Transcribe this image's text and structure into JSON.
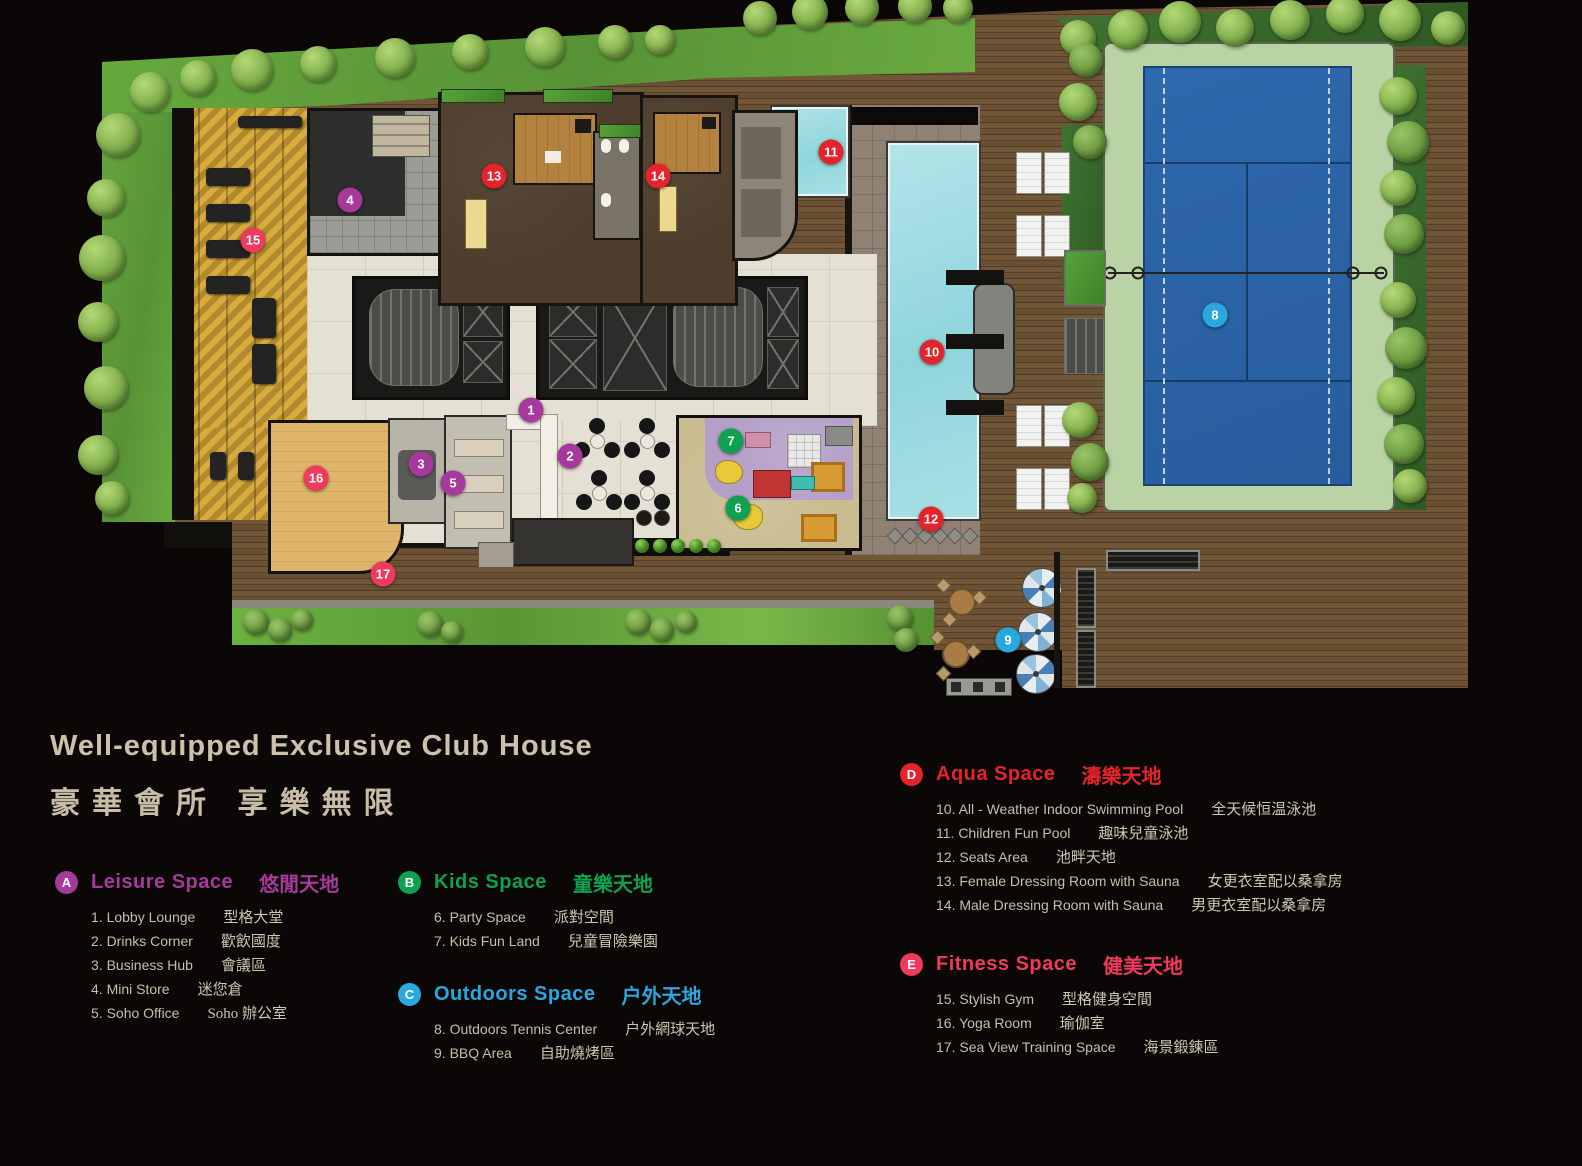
{
  "title": {
    "en": "Well-equipped Exclusive Club House",
    "zh": "豪華會所  享樂無限"
  },
  "palette": {
    "background": "#0a0706",
    "title_text": "#cdc1ab",
    "item_text": "#c8bead",
    "deck_wood": "#6a5134",
    "lawn_green": "#5f9c3c",
    "pool_water": "#a5dde2",
    "tennis_court_blue": "#2b64a8",
    "tennis_surround_green": "#b9d3a4",
    "gym_floor_gold": "#d8a83a",
    "yoga_floor": "#dcb06a",
    "kids_carpet": "#b49fc7",
    "marble_floor": "#e5e0d4"
  },
  "legend": {
    "sections": [
      {
        "letter": "A",
        "color": "#a63a9c",
        "title_en": "Leisure Space",
        "title_zh": "悠閒天地",
        "items": [
          {
            "en": "1. Lobby Lounge",
            "zh": "型格大堂"
          },
          {
            "en": "2. Drinks  Corner",
            "zh": "歡飲國度"
          },
          {
            "en": "3. Business Hub",
            "zh": "會議區"
          },
          {
            "en": "4. Mini Store",
            "zh": "迷您倉"
          },
          {
            "en": "5. Soho Office",
            "zh": "Soho 辦公室"
          }
        ]
      },
      {
        "letter": "B",
        "color": "#0da150",
        "title_en": "Kids Space",
        "title_zh": "童樂天地",
        "items": [
          {
            "en": "6. Party Space",
            "zh": "派對空間"
          },
          {
            "en": "7. Kids Fun Land",
            "zh": "兒童冒險樂園"
          }
        ]
      },
      {
        "letter": "C",
        "color": "#29a8e0",
        "title_en": "Outdoors Space",
        "title_zh": "户外天地",
        "items": [
          {
            "en": "8. Outdoors Tennis Center",
            "zh": "户外網球天地"
          },
          {
            "en": "9. BBQ Area",
            "zh": "自助燒烤區"
          }
        ]
      },
      {
        "letter": "D",
        "color": "#e5232b",
        "title_en": "Aqua Space",
        "title_zh": "濤樂天地",
        "items": [
          {
            "en": "10. All - Weather Indoor Swimming Pool",
            "zh": "全天候恒温泳池"
          },
          {
            "en": "11. Children Fun Pool",
            "zh": "趣味兒童泳池"
          },
          {
            "en": "12. Seats Area",
            "zh": "池畔天地"
          },
          {
            "en": "13. Female Dressing Room with Sauna",
            "zh": "女更衣室配以桑拿房"
          },
          {
            "en": "14. Male Dressing Room with Sauna",
            "zh": "男更衣室配以桑拿房"
          }
        ]
      },
      {
        "letter": "E",
        "color": "#ee3a5c",
        "title_en": "Fitness Space",
        "title_zh": "健美天地",
        "items": [
          {
            "en": "15. Stylish Gym",
            "zh": "型格健身空間"
          },
          {
            "en": "16. Yoga Room",
            "zh": "瑜伽室"
          },
          {
            "en": "17. Sea View Training Space",
            "zh": "海景鍛鍊區"
          }
        ]
      }
    ]
  },
  "plan": {
    "markers": [
      {
        "n": "1",
        "group": "A",
        "x": 531,
        "y": 410
      },
      {
        "n": "2",
        "group": "A",
        "x": 570,
        "y": 456
      },
      {
        "n": "3",
        "group": "A",
        "x": 421,
        "y": 464
      },
      {
        "n": "4",
        "group": "A",
        "x": 350,
        "y": 200
      },
      {
        "n": "5",
        "group": "A",
        "x": 453,
        "y": 483
      },
      {
        "n": "6",
        "group": "B",
        "x": 738,
        "y": 508
      },
      {
        "n": "7",
        "group": "B",
        "x": 731,
        "y": 441
      },
      {
        "n": "8",
        "group": "C",
        "x": 1215,
        "y": 315
      },
      {
        "n": "9",
        "group": "C",
        "x": 1008,
        "y": 640
      },
      {
        "n": "10",
        "group": "D",
        "x": 932,
        "y": 352
      },
      {
        "n": "11",
        "group": "D",
        "x": 831,
        "y": 152
      },
      {
        "n": "12",
        "group": "D",
        "x": 931,
        "y": 519
      },
      {
        "n": "13",
        "group": "D",
        "x": 494,
        "y": 176
      },
      {
        "n": "14",
        "group": "D",
        "x": 658,
        "y": 176
      },
      {
        "n": "15",
        "group": "E",
        "x": 253,
        "y": 240
      },
      {
        "n": "16",
        "group": "E",
        "x": 316,
        "y": 478
      },
      {
        "n": "17",
        "group": "E",
        "x": 383,
        "y": 574
      }
    ]
  }
}
